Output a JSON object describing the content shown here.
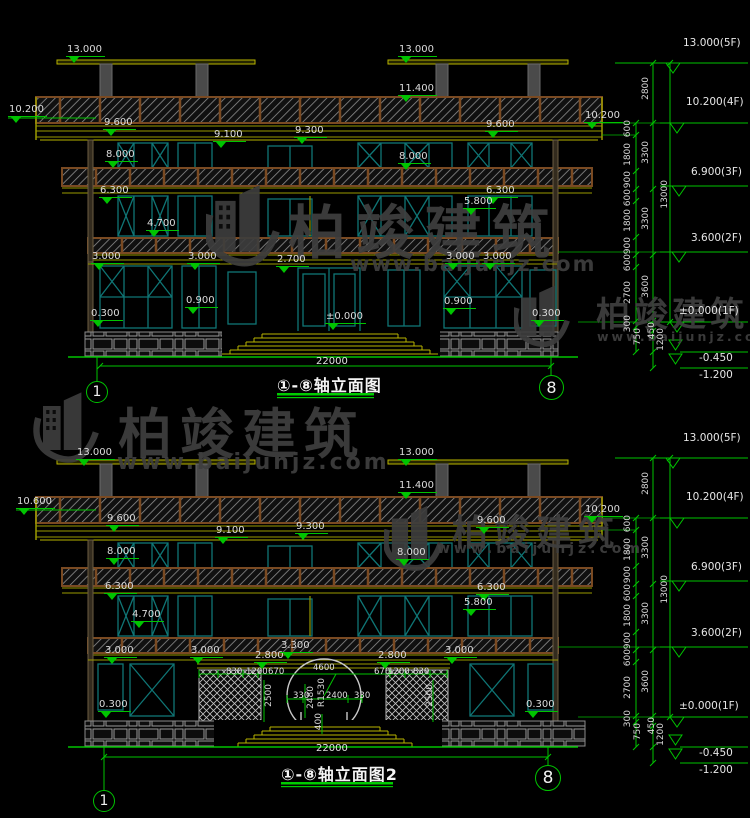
{
  "watermark": {
    "brand": "柏竣建筑",
    "url": "www.baijunjz.com"
  },
  "elev": {
    "e13000": "13.000",
    "e11400": "11.400",
    "e10600": "10.600",
    "e10200": "10.200",
    "e9600": "9.600",
    "e9100": "9.100",
    "e9300": "9.300",
    "e8000": "8.000",
    "e6300": "6.300",
    "e5800": "5.800",
    "e4700": "4.700",
    "e3300": "3.300",
    "e3000": "3.000",
    "e2800": "2.800",
    "e2700": "2.700",
    "e0900": "0.900",
    "e0300": "0.300",
    "zero": "±0.000"
  },
  "dims": {
    "w22000": "22000"
  },
  "arch": {
    "d830": "830",
    "d1200": "1200",
    "d670": "670",
    "d4600": "4600",
    "d2400": "2400",
    "d330": "330",
    "d2480": "2480",
    "d400": "400",
    "d2500": "2500",
    "r1530": "R1530"
  },
  "levels": {
    "f5": "13.000(5F)",
    "f4": "10.200(4F)",
    "f3": "6.900(3F)",
    "f2": "3.600(2F)",
    "f1": "±0.000(1F)",
    "m045": "-0.450",
    "m120": "-1.200"
  },
  "vdims": {
    "d2800": "2800",
    "d600": "600",
    "d1800": "1800",
    "d900": "900",
    "d2700": "2700",
    "d300": "300",
    "d750": "750",
    "d450": "450",
    "d1200": "1200",
    "d3300": "3300",
    "d3600": "3600",
    "d13000": "13000"
  },
  "d1": {
    "title": "①-⑧轴立面图",
    "axisLeft": "1",
    "axisRight": "8"
  },
  "d2": {
    "title": "①-⑧轴立面图2",
    "axisLeft": "1",
    "axisRight": "8"
  }
}
